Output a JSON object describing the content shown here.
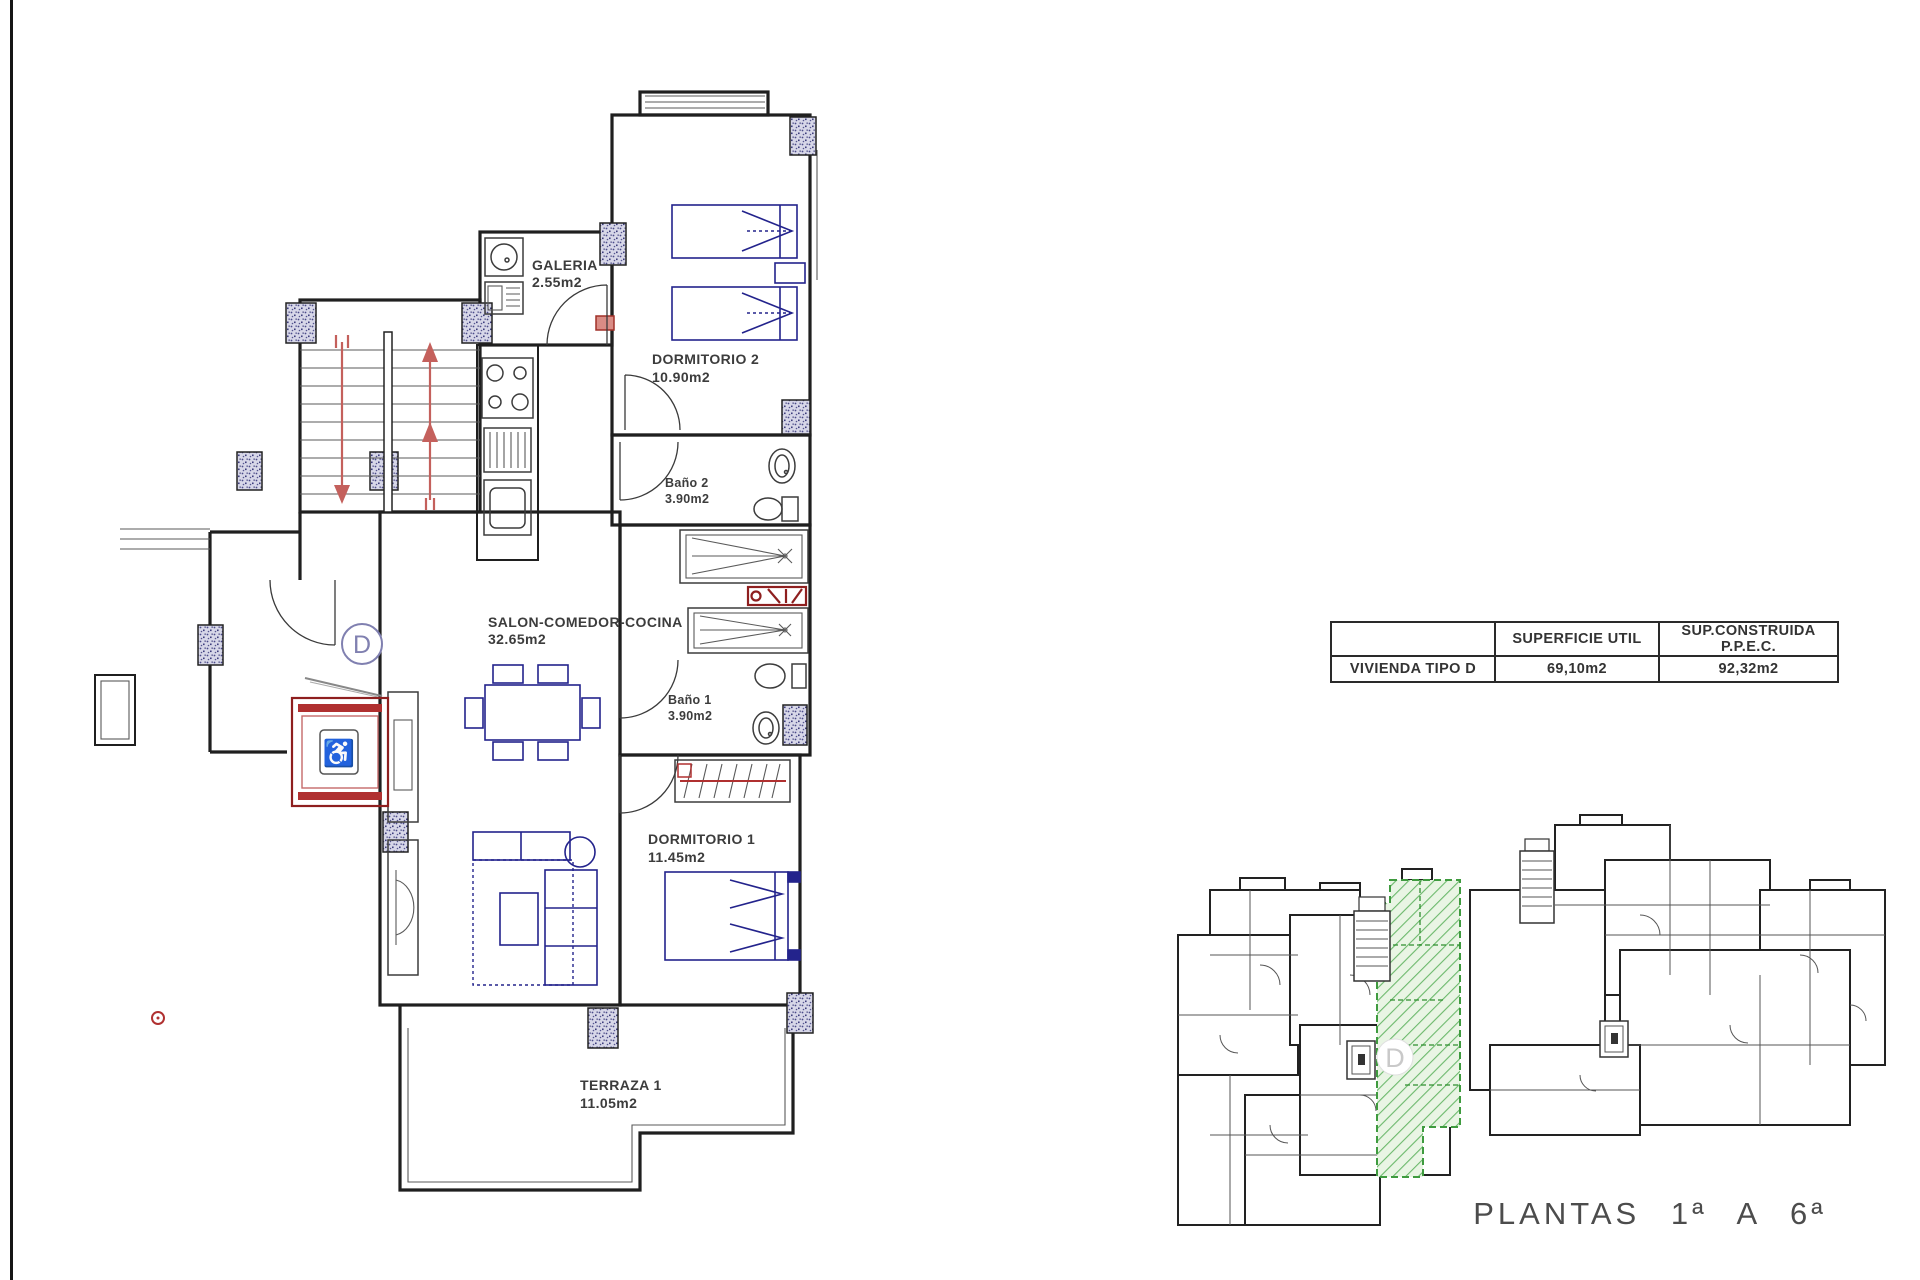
{
  "drawing": {
    "unit_circle_label": "D",
    "rooms": [
      {
        "id": "galeria",
        "name": "GALERIA",
        "area": "2.55m2"
      },
      {
        "id": "dormitorio2",
        "name": "DORMITORIO 2",
        "area": "10.90m2"
      },
      {
        "id": "bano2",
        "name": "Baño 2",
        "area": "3.90m2"
      },
      {
        "id": "salon",
        "name": "SALON-COMEDOR-COCINA",
        "area": "32.65m2"
      },
      {
        "id": "bano1",
        "name": "Baño 1",
        "area": "3.90m2"
      },
      {
        "id": "dormitorio1",
        "name": "DORMITORIO 1",
        "area": "11.45m2"
      },
      {
        "id": "terraza",
        "name": "TERRAZA 1",
        "area": "11.05m2"
      }
    ]
  },
  "summary_table": {
    "headers": [
      "",
      "SUPERFICIE UTIL",
      "SUP.CONSTRUIDA P.P.E.C."
    ],
    "rows": [
      {
        "label": "VIVIENDA TIPO D",
        "superficie_util": "69,10m2",
        "sup_construida": "92,32m2"
      }
    ]
  },
  "overview": {
    "caption": "PLANTAS 1ª A 6ª",
    "highlight_unit": "D"
  },
  "colors": {
    "walls": "#1f1f1f",
    "furniture_blue": "#23238c",
    "stair_arrow_red": "#c4605c",
    "elevator_red": "#8e1f1f",
    "highlight_green": "#3f9b3f",
    "highlight_green_fill": "#e9f5e4",
    "column_fill": "#d7d7e8",
    "text": "#3c3c3c"
  }
}
